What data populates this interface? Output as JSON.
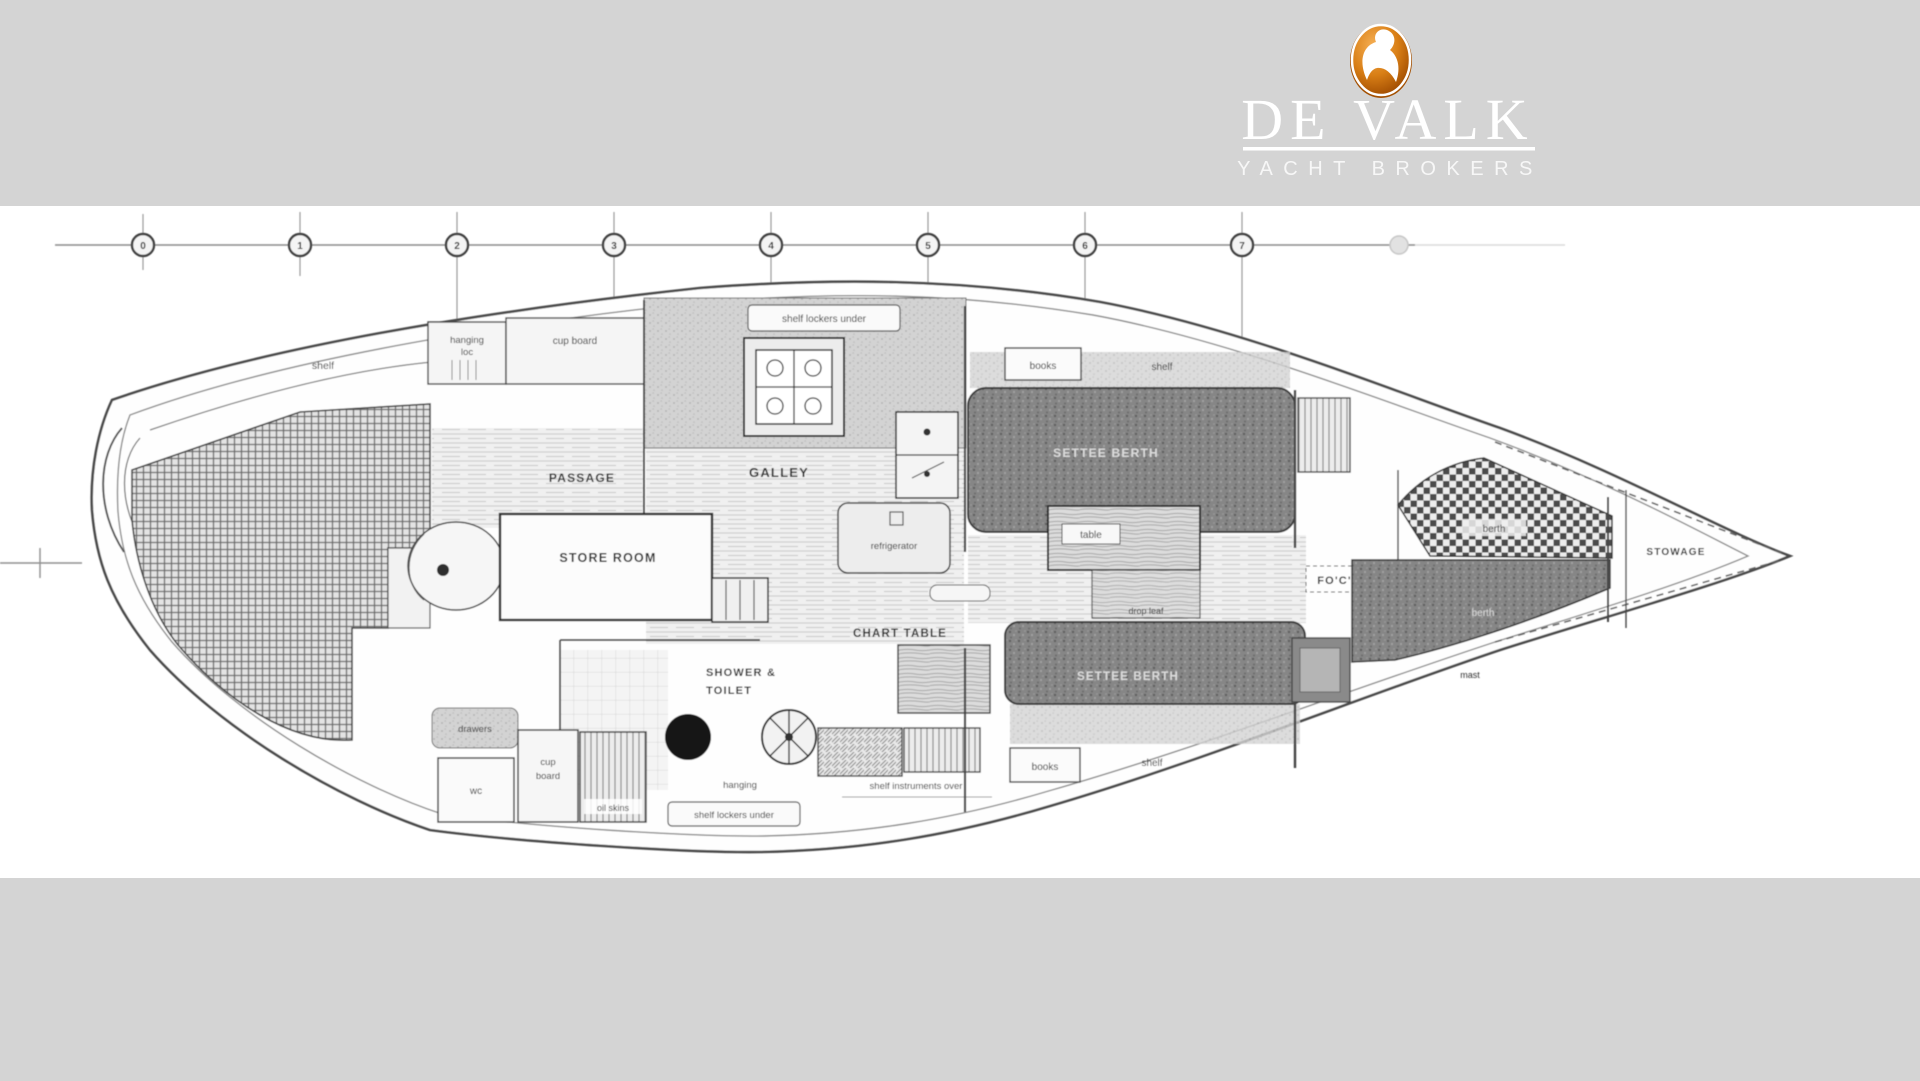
{
  "colors": {
    "band_gray": "#d4d4d4",
    "paper_white": "#ffffff",
    "ink": "#3a3a3a",
    "logo_orange": "#c4660a",
    "dark_upholstery": "#858585"
  },
  "brand": {
    "logo_icon": "falcon-icon",
    "name": "DE VALK",
    "tagline": "YACHT BROKERS"
  },
  "stations": [
    "0",
    "1",
    "2",
    "3",
    "4",
    "5",
    "6",
    "7"
  ],
  "plan": {
    "aft": {
      "shelf": "shelf",
      "hanging_line1": "hanging",
      "hanging_line2": "loc",
      "cupboard": "cup board",
      "drawers": "drawers",
      "wc": "wc",
      "cupboard_b_line1": "cup",
      "cupboard_b_line2": "board",
      "oilskins": "oil skins"
    },
    "galley": {
      "shelf_lockers": "shelf lockers under",
      "title": "GALLEY",
      "refrigerator": "refrigerator"
    },
    "center": {
      "passage": "PASSAGE",
      "store_room": "STORE ROOM",
      "chart_table": "CHART TABLE",
      "shower_line1": "SHOWER &",
      "shower_line2": "TOILET",
      "hanging": "hanging",
      "shelf_lockers": "shelf lockers under",
      "shelf_instruments": "shelf instruments over"
    },
    "saloon": {
      "settee_top": "SETTEE BERTH",
      "settee_bottom": "SETTEE BERTH",
      "table": "table",
      "drop_leaf": "drop leaf",
      "books_top": "books",
      "shelf_top": "shelf",
      "books_bottom": "books",
      "shelf_bottom": "shelf"
    },
    "fwd": {
      "focsle": "FO'C'SLE",
      "berth_top": "berth",
      "berth_bottom": "berth",
      "mast": "mast",
      "stowage": "STOWAGE"
    }
  }
}
